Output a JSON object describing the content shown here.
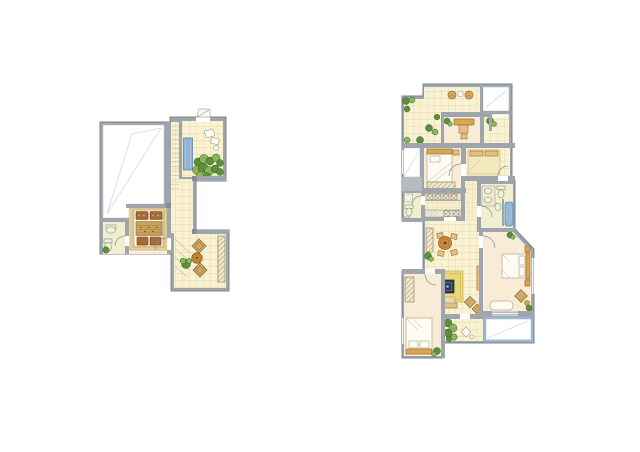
{
  "page": {
    "background": "#ffffff",
    "description": "Two hand-drawn watercolor architectural floor plans of a duplex apartment on a plain white background; smaller loft level plan at left, larger main level plan at right",
    "text_content": ""
  },
  "palette": {
    "wall": "#9fa5ad",
    "wallDark": "#7d838c",
    "wallLight": "#b7bcc2",
    "tileFloor": "#f9f3d3",
    "tileLine": "#ddd2a2",
    "cream": "#f8ecd6",
    "fixtureFloor": "#f1efd0",
    "plant": "#5d8f3c",
    "plantDark": "#3a611f",
    "plantLight": "#8ab45e",
    "water": "#8fb6d9",
    "waterDark": "#5f88ab",
    "wood": "#d8a755",
    "woodDark": "#a06c2a",
    "woodLight": "#e3c088",
    "bedBrown": "#a86b32",
    "blanket": "#c9a258",
    "navy": "#2e3a55",
    "rug": "#e9d873",
    "balcony": "#9db6c9",
    "lineThin": "#bfc3c8"
  },
  "plans": [
    {
      "id": "upper-floor-plan",
      "position": "left",
      "rooms": [
        "void-double-height-space",
        "garden-terrace",
        "staircase-corridor",
        "bedroom",
        "bathroom",
        "tea-room"
      ],
      "furniture": [
        "planter",
        "plants",
        "lounge-chair",
        "double-bed",
        "washbasin",
        "toilet",
        "floor-cushions",
        "round-tea-table",
        "side-cabinet",
        "stairs"
      ]
    },
    {
      "id": "lower-floor-plan",
      "position": "right",
      "rooms": [
        "roof-terrace",
        "stairwell",
        "study",
        "east-terrace",
        "light-well",
        "bedroom-a",
        "tatami-room",
        "utility-room",
        "kitchen",
        "hallway",
        "bathroom",
        "living-dining-room",
        "master-bedroom",
        "bedroom-b",
        "rear-terrace",
        "balcony"
      ],
      "furniture": [
        "terrace-chairs",
        "desk",
        "single-bed",
        "wardrobe",
        "tatami-platform",
        "washing-machine",
        "kitchen-counters",
        "double-vanity",
        "toilet",
        "bathtub",
        "dining-table",
        "sideboard",
        "sofa",
        "coffee-table",
        "area-rug",
        "tv-bench",
        "double-bed",
        "chaise-lounge",
        "plants"
      ]
    }
  ]
}
